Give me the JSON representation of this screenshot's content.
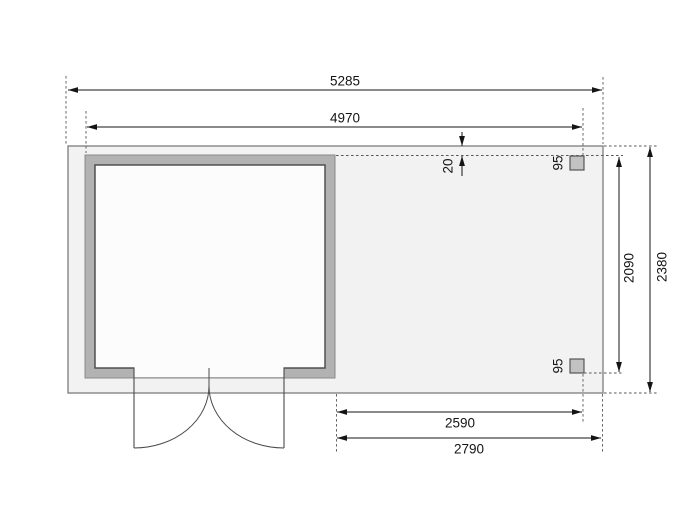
{
  "drawing": {
    "type": "floor-plan-dimension-drawing",
    "dims": {
      "overall_width": "5285",
      "cabin_width": "4970",
      "front_gap": "20",
      "post_width_top": "95",
      "post_width_bottom": "95",
      "canopy_depth": "2090",
      "total_depth": "2380",
      "canopy_width": "2590",
      "canopy_overall_width": "2790"
    },
    "colors": {
      "background": "#ffffff",
      "floor_fill": "#f2f2f2",
      "wall_fill": "#b2b2b2",
      "wall_inner_line": "#474747",
      "post_fill": "#c2c2c2",
      "dimension_line": "#141414",
      "extension_line": "#5a5a5a"
    }
  }
}
